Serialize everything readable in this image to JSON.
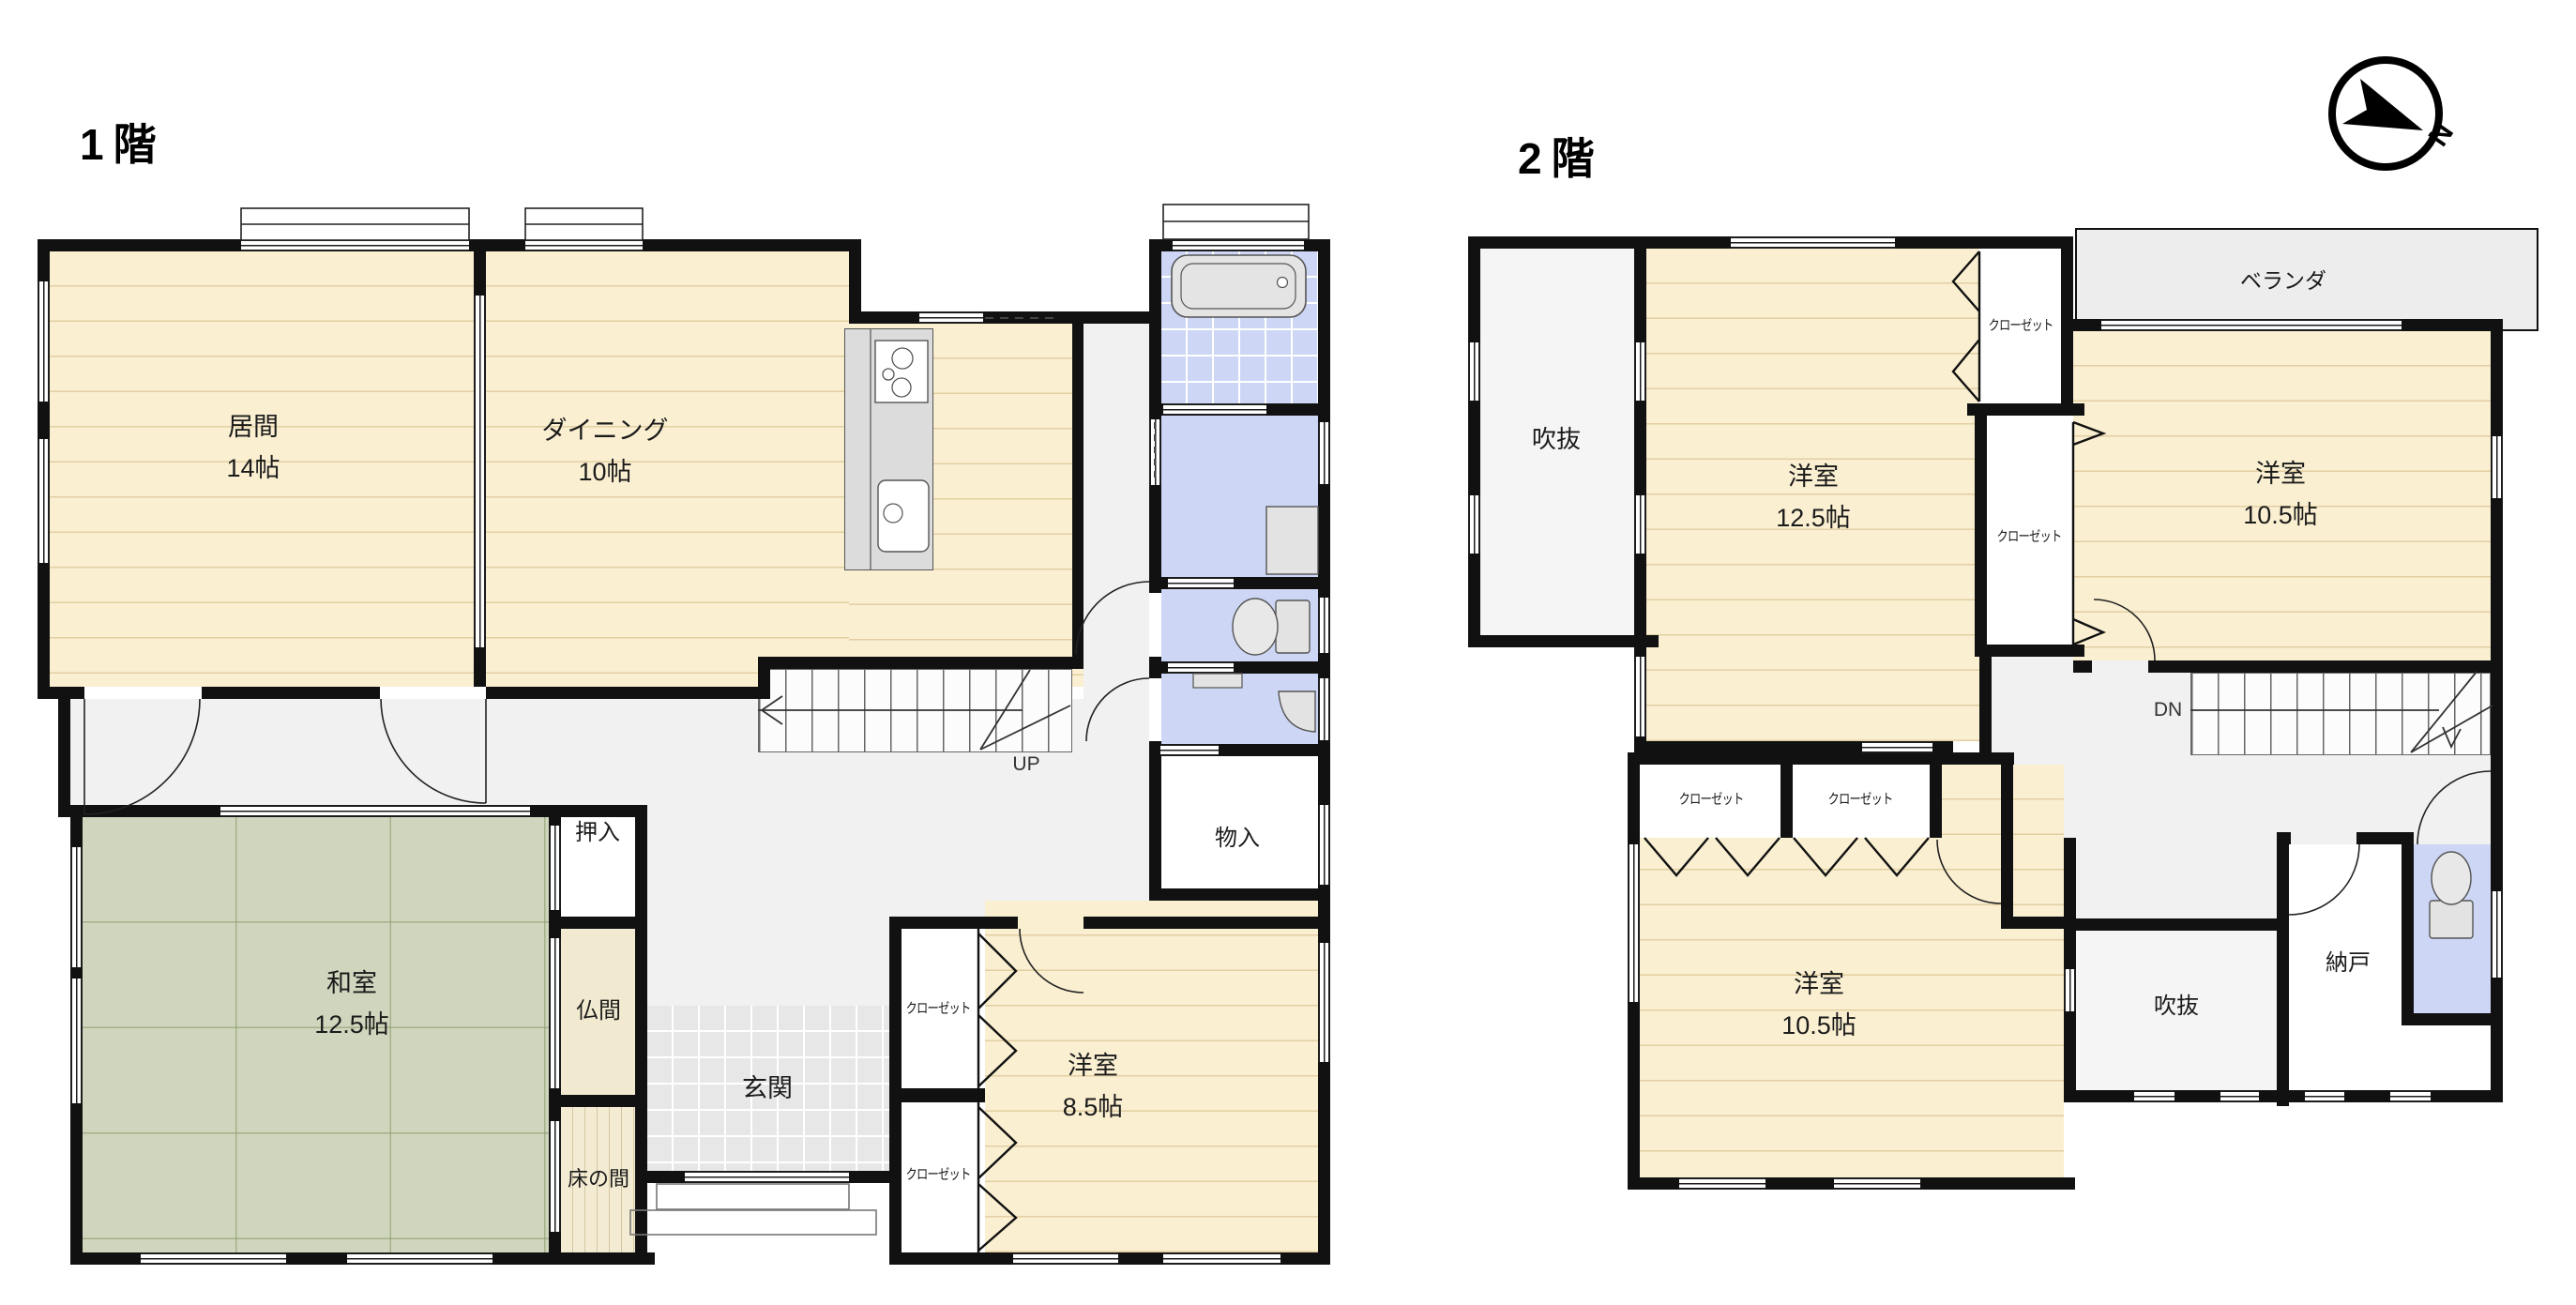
{
  "floor1": {
    "title": "1階",
    "stairs_label": "UP",
    "rooms": {
      "living": {
        "name": "居間",
        "size": "14帖"
      },
      "dining": {
        "name": "ダイニング",
        "size": "10帖"
      },
      "washitsu": {
        "name": "和室",
        "size": "12.5帖"
      },
      "oshiire": {
        "name": "押入"
      },
      "butsuma": {
        "name": "仏間"
      },
      "tokonoma": {
        "name": "床の間"
      },
      "genkan": {
        "name": "玄関"
      },
      "monoire": {
        "name": "物入"
      },
      "yoshitsu85": {
        "name": "洋室",
        "size": "8.5帖"
      },
      "closet1": {
        "name": "クローゼット"
      },
      "closet2": {
        "name": "クローゼット"
      }
    }
  },
  "floor2": {
    "title": "2階",
    "stairs_label": "DN",
    "rooms": {
      "fukinuke_top": {
        "name": "吹抜"
      },
      "yoshitsu125": {
        "name": "洋室",
        "size": "12.5帖"
      },
      "closet_upper": {
        "name": "クローゼット"
      },
      "closet_lower": {
        "name": "クローゼット"
      },
      "veranda": {
        "name": "ベランダ"
      },
      "yoshitsu105a": {
        "name": "洋室",
        "size": "10.5帖"
      },
      "closet_a": {
        "name": "クローゼット"
      },
      "closet_b": {
        "name": "クローゼット"
      },
      "yoshitsu105b": {
        "name": "洋室",
        "size": "10.5帖"
      },
      "fukinuke_bottom": {
        "name": "吹抜"
      },
      "nando": {
        "name": "納戸"
      }
    }
  },
  "compass": {
    "label": "N"
  },
  "colors": {
    "wall": "#111111",
    "wood_floor": "#faefd1",
    "tatami": "#d0d6be",
    "wet_area_blue": "#cdd7f5",
    "hallway": "#f1f1f1",
    "veranda": "#ededed",
    "void": "#f5f5f5"
  }
}
